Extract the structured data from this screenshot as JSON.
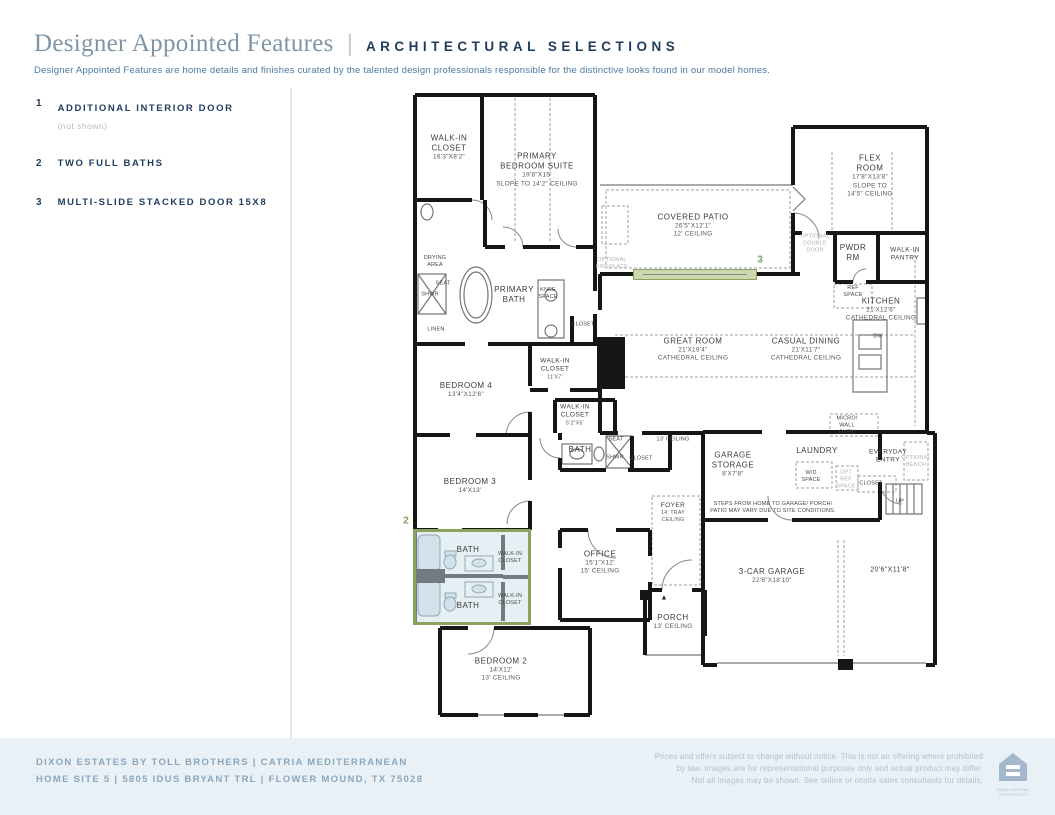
{
  "colors": {
    "accent_green": "#7ba05b",
    "accent_border": "#8aa45e",
    "navy": "#1f3c5e",
    "title_blue": "#7e95a6",
    "footer_bg": "#eaf1f6"
  },
  "header": {
    "title": "Designer Appointed Features",
    "separator": "|",
    "subtitle_heading": "ARCHITECTURAL SELECTIONS",
    "description": "Designer Appointed Features are home details and finishes curated by the talented design professionals responsible for the distinctive looks found in our model homes."
  },
  "features": [
    {
      "number": "1",
      "label": "ADDITIONAL INTERIOR DOOR",
      "note": "(not shown)"
    },
    {
      "number": "2",
      "label": "TWO FULL BATHS",
      "note": ""
    },
    {
      "number": "3",
      "label": "MULTI-SLIDE STACKED DOOR 15X8",
      "note": ""
    }
  ],
  "plan": {
    "highlights": [
      {
        "number": "2",
        "type": "box",
        "x": 3,
        "y": 441,
        "w": 118,
        "h": 96,
        "num_x": -4,
        "num_y": 433
      },
      {
        "number": "3",
        "type": "band",
        "x": 223,
        "y": 181,
        "w": 124,
        "h": 11,
        "num_x": 350,
        "num_y": 172
      }
    ],
    "labels": [
      {
        "x": 39,
        "y": 60,
        "cls": "room",
        "lines": [
          "WALK-IN",
          "CLOSET"
        ],
        "sub": [
          "16'3\"X8'2\""
        ]
      },
      {
        "x": 127,
        "y": 82,
        "cls": "room",
        "lines": [
          "PRIMARY",
          "BEDROOM SUITE"
        ],
        "sub": [
          "19'8\"X15'",
          "SLOPE TO 14'2\" CEILING"
        ]
      },
      {
        "x": 283,
        "y": 138,
        "cls": "room",
        "lines": [
          "COVERED PATIO"
        ],
        "sub": [
          "26'5\"X12'1\"",
          "12' CEILING"
        ]
      },
      {
        "x": 460,
        "y": 88,
        "cls": "room",
        "lines": [
          "FLEX",
          "ROOM"
        ],
        "sub": [
          "17'8\"X13'8\"",
          "SLOPE TO",
          "14'5\" CEILING"
        ]
      },
      {
        "x": 443,
        "y": 165,
        "cls": "room",
        "lines": [
          "PWDR",
          "RM"
        ]
      },
      {
        "x": 495,
        "y": 167,
        "cls": "small",
        "lines": [
          "WALK-IN",
          "PANTRY"
        ]
      },
      {
        "x": 471,
        "y": 222,
        "cls": "room",
        "lines": [
          "KITCHEN"
        ],
        "sub": [
          "21'X12'6\"",
          "CATHEDRAL CEILING"
        ]
      },
      {
        "x": 283,
        "y": 262,
        "cls": "room",
        "lines": [
          "GREAT ROOM"
        ],
        "sub": [
          "21'X19'4\"",
          "CATHEDRAL CEILING"
        ]
      },
      {
        "x": 396,
        "y": 262,
        "cls": "room",
        "lines": [
          "CASUAL DINING"
        ],
        "sub": [
          "21'X11'7\"",
          "CATHEDRAL CEILING"
        ]
      },
      {
        "x": 104,
        "y": 207,
        "cls": "room",
        "lines": [
          "PRIMARY",
          "BATH"
        ]
      },
      {
        "x": 56,
        "y": 302,
        "cls": "room",
        "lines": [
          "BEDROOM 4"
        ],
        "sub": [
          "13'4\"X12'6\""
        ]
      },
      {
        "x": 145,
        "y": 281,
        "cls": "small",
        "lines": [
          "WALK-IN",
          "CLOSET"
        ],
        "sub": [
          "11'X7'"
        ]
      },
      {
        "x": 165,
        "y": 327,
        "cls": "small",
        "lines": [
          "WALK-IN",
          "CLOSET"
        ],
        "sub": [
          "5'2\"X5'"
        ]
      },
      {
        "x": 170,
        "y": 362,
        "cls": "room",
        "lines": [
          "BATH"
        ]
      },
      {
        "x": 60,
        "y": 398,
        "cls": "room",
        "lines": [
          "BEDROOM 3"
        ],
        "sub": [
          "14'X13'"
        ]
      },
      {
        "x": 323,
        "y": 377,
        "cls": "room",
        "lines": [
          "GARAGE",
          "STORAGE"
        ],
        "sub": [
          "8'X7'8\""
        ]
      },
      {
        "x": 407,
        "y": 363,
        "cls": "room",
        "lines": [
          "LAUNDRY"
        ]
      },
      {
        "x": 263,
        "y": 425,
        "cls": "small",
        "lines": [
          "FOYER"
        ],
        "sub": [
          "14' TRAY",
          "CEILING"
        ]
      },
      {
        "x": 190,
        "y": 475,
        "cls": "room",
        "lines": [
          "OFFICE"
        ],
        "sub": [
          "15'1\"X12'",
          "15' CEILING"
        ]
      },
      {
        "x": 58,
        "y": 462,
        "cls": "room",
        "lines": [
          "BATH"
        ]
      },
      {
        "x": 58,
        "y": 518,
        "cls": "room",
        "lines": [
          "BATH"
        ]
      },
      {
        "x": 100,
        "y": 470,
        "cls": "tiny",
        "lines": [
          "WALK-IN",
          "CLOSET"
        ]
      },
      {
        "x": 100,
        "y": 512,
        "cls": "tiny",
        "lines": [
          "WALK-IN",
          "CLOSET"
        ]
      },
      {
        "x": 263,
        "y": 534,
        "cls": "room",
        "lines": [
          "PORCH"
        ],
        "sub": [
          "13' CEILING"
        ]
      },
      {
        "x": 362,
        "y": 488,
        "cls": "room",
        "lines": [
          "3-CAR GARAGE"
        ],
        "sub": [
          "22'6\"X18'10\""
        ]
      },
      {
        "x": 480,
        "y": 483,
        "cls": "dim",
        "lines": [
          "20'6\"X11'8\""
        ]
      },
      {
        "x": 91,
        "y": 582,
        "cls": "room",
        "lines": [
          "BEDROOM 2"
        ],
        "sub": [
          "14'X12'",
          "13' CEILING"
        ]
      },
      {
        "x": 363,
        "y": 420,
        "cls": "tiny",
        "lines": [
          "STEPS FROM HOME TO GARAGE/ PORCH/",
          "PATIO MAY VARY DUE TO SITE CONDITIONS."
        ]
      },
      {
        "x": 478,
        "y": 369,
        "cls": "small",
        "lines": [
          "EVERYDAY",
          "ENTRY"
        ]
      },
      {
        "x": 25,
        "y": 174,
        "cls": "tiny",
        "lines": [
          "DRYING",
          "AREA"
        ]
      },
      {
        "x": 33,
        "y": 196,
        "cls": "tiny",
        "lines": [
          "SEAT"
        ]
      },
      {
        "x": 20,
        "y": 207,
        "cls": "tiny",
        "lines": [
          "SHWR"
        ]
      },
      {
        "x": 138,
        "y": 206,
        "cls": "tiny",
        "lines": [
          "KNEE",
          "SPACE"
        ]
      },
      {
        "x": 26,
        "y": 242,
        "cls": "tiny",
        "lines": [
          "LINEN"
        ]
      },
      {
        "x": 173,
        "y": 237,
        "cls": "tiny",
        "lines": [
          "CLOSET"
        ]
      },
      {
        "x": 206,
        "y": 352,
        "cls": "tiny",
        "lines": [
          "SEAT"
        ]
      },
      {
        "x": 205,
        "y": 370,
        "cls": "tiny",
        "lines": [
          "SHWR"
        ]
      },
      {
        "x": 231,
        "y": 371,
        "cls": "tiny",
        "lines": [
          "CLOSET"
        ]
      },
      {
        "x": 263,
        "y": 352,
        "cls": "tiny",
        "lines": [
          "13' CEILING"
        ]
      },
      {
        "x": 443,
        "y": 204,
        "cls": "tiny",
        "lines": [
          "REF",
          "SPACE"
        ]
      },
      {
        "x": 468,
        "y": 249,
        "cls": "tiny",
        "lines": [
          "DW"
        ]
      },
      {
        "x": 437,
        "y": 338,
        "cls": "tiny",
        "lines": [
          "MICRO/",
          "WALL",
          "OVEN"
        ]
      },
      {
        "x": 401,
        "y": 389,
        "cls": "tiny",
        "lines": [
          "W/D",
          "SPACE"
        ]
      },
      {
        "x": 461,
        "y": 396,
        "cls": "tiny",
        "lines": [
          "CLOSET"
        ]
      },
      {
        "x": 490,
        "y": 414,
        "cls": "tiny",
        "lines": [
          "UP"
        ]
      },
      {
        "x": 254,
        "y": 511,
        "cls": "mark",
        "lines": [
          "▲"
        ]
      },
      {
        "x": 405,
        "y": 156,
        "cls": "muted",
        "lines": [
          "OPTIONAL",
          "DOUBLE",
          "DOOR"
        ]
      },
      {
        "x": 202,
        "y": 176,
        "cls": "muted",
        "lines": [
          "OPTIONAL",
          "FIREPLACE"
        ]
      },
      {
        "x": 436,
        "y": 392,
        "cls": "muted",
        "lines": [
          "OPT",
          "REF",
          "SPACE"
        ]
      },
      {
        "x": 506,
        "y": 374,
        "cls": "muted",
        "lines": [
          "OPTIONAL",
          "BENCH"
        ]
      }
    ]
  },
  "footer": {
    "left_line1": "DIXON ESTATES BY TOLL BROTHERS  |  CATRIA MEDITERRANEAN",
    "left_line2": "HOME SITE 5  |  5805 IDUS BRYANT TRL  |  FLOWER MOUND, TX 75028",
    "disclaimer_line1": "Prices and offers subject to change without notice. This is not an offering where prohibited",
    "disclaimer_line2": "by law. Images are for representational purposes only and actual product may differ.",
    "disclaimer_line3": "Not all images may be shown. See online or onsite sales consultants for details.",
    "equal_housing_line1": "EQUAL HOUSING",
    "equal_housing_line2": "OPPORTUNITY"
  }
}
